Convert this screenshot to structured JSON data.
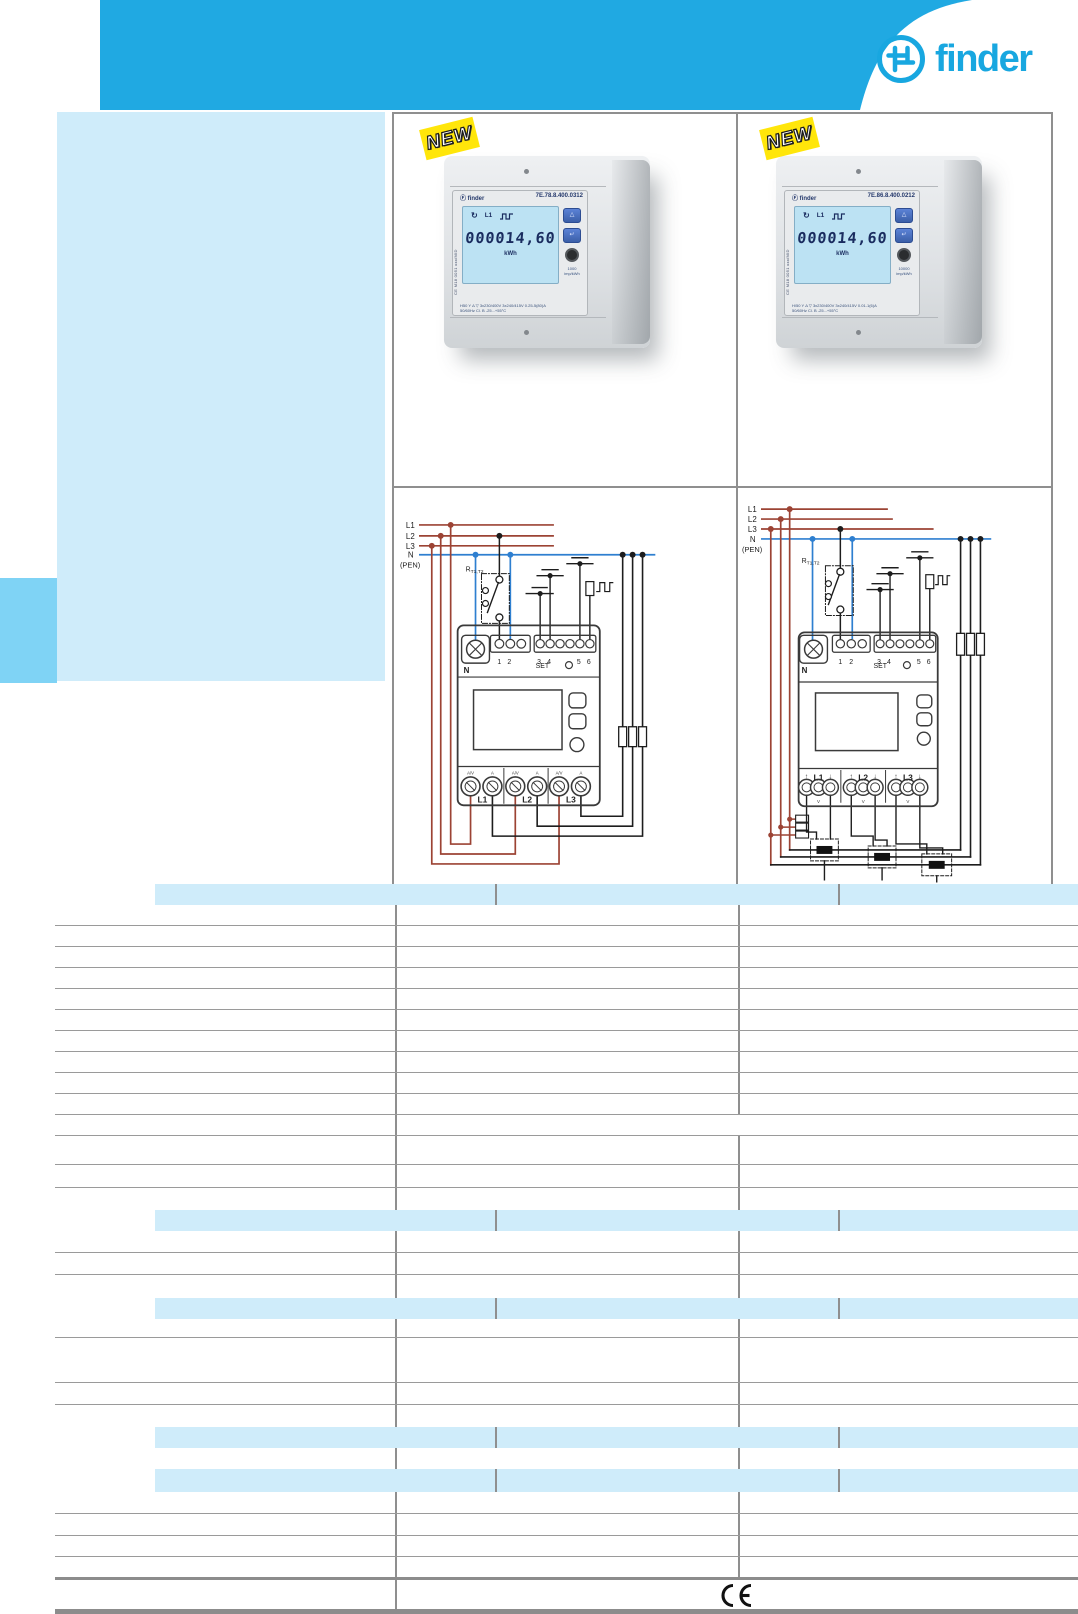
{
  "header": {
    "brand": "finder"
  },
  "products": [
    {
      "badge": "NEW",
      "brand_label": "Ⓕ finder",
      "model": "7E.78.8.400.0312",
      "cert": "CE M18 0051 xxx/MID",
      "lcd": {
        "phase": "L1",
        "value": "000014,60",
        "unit": "kWh"
      },
      "pulse_rate": "1000",
      "pulse_unit": "imp/kWh",
      "ratings_line1": "H50   Y Δ ▽   3x230/400V  3x240/415V   0.25-5(80)A",
      "ratings_line2": "50/60Hz   Cl. B    -25...+55°C"
    },
    {
      "badge": "NEW",
      "brand_label": "Ⓕ finder",
      "model": "7E.86.8.400.0212",
      "cert": "CE M18 0051 xxx/MID",
      "lcd": {
        "phase": "L1",
        "value": "000014,60",
        "unit": "kWh"
      },
      "pulse_rate": "10000",
      "pulse_unit": "imp/kWh",
      "ratings_line1": "H/50   Y Δ ▽   3x230/400V  3x240/415V   0.01-1(6)A",
      "ratings_line2": "50/60Hz   Cl. B    -25...+55°C"
    }
  ],
  "icons": {
    "rotate": "↻",
    "up": "△",
    "enter": "↵"
  },
  "diagram": {
    "lines": [
      "L1",
      "L2",
      "L3",
      "N",
      "(PEN)"
    ],
    "relay": "R",
    "relay_sub": "T1,T2",
    "terminals": [
      "1",
      "2",
      "3",
      "4",
      "5",
      "6"
    ],
    "set_label": "SET",
    "neutral": "N",
    "phases": [
      "L1",
      "L2",
      "L3"
    ],
    "marking_av": "A/V",
    "marking_a": "A",
    "volt": "V",
    "arrow_up": "↑",
    "arrow_down": "↓"
  },
  "colors": {
    "accent": "#20A9E2",
    "panel": "#CFECFA",
    "tab": "#7FD3F5",
    "wire_red": "#9C4334",
    "wire_blue": "#2E7FD0"
  },
  "table": {
    "rows": [
      {
        "h": 21,
        "kind": "band"
      },
      {
        "h": 21,
        "kind": "row",
        "lined": true
      },
      {
        "h": 21,
        "kind": "row",
        "lined": true
      },
      {
        "h": 21,
        "kind": "row",
        "lined": true
      },
      {
        "h": 21,
        "kind": "row",
        "lined": true
      },
      {
        "h": 21,
        "kind": "row",
        "lined": true
      },
      {
        "h": 21,
        "kind": "row",
        "lined": true
      },
      {
        "h": 21,
        "kind": "row",
        "lined": true
      },
      {
        "h": 21,
        "kind": "row",
        "lined": true
      },
      {
        "h": 21,
        "kind": "row",
        "lined": true
      },
      {
        "h": 21,
        "kind": "row",
        "lined": true
      },
      {
        "h": 21,
        "kind": "row",
        "lined": true,
        "d2": false
      },
      {
        "h": 29,
        "kind": "row",
        "lined": true
      },
      {
        "h": 23,
        "kind": "row",
        "lined": true
      },
      {
        "h": 22,
        "kind": "row",
        "lined": false
      },
      {
        "h": 21,
        "kind": "band"
      },
      {
        "h": 22,
        "kind": "row",
        "lined": true
      },
      {
        "h": 22,
        "kind": "row",
        "lined": true
      },
      {
        "h": 23,
        "kind": "row",
        "lined": false
      },
      {
        "h": 21,
        "kind": "band"
      },
      {
        "h": 19,
        "kind": "row",
        "lined": true
      },
      {
        "h": 45,
        "kind": "row",
        "lined": true
      },
      {
        "h": 22,
        "kind": "row",
        "lined": true
      },
      {
        "h": 22,
        "kind": "row",
        "lined": false
      },
      {
        "h": 21,
        "kind": "band"
      },
      {
        "h": 21,
        "kind": "row",
        "lined": false
      },
      {
        "h": 23,
        "kind": "band"
      },
      {
        "h": 22,
        "kind": "row",
        "lined": true
      },
      {
        "h": 22,
        "kind": "row",
        "lined": true
      },
      {
        "h": 21,
        "kind": "row",
        "lined": true
      },
      {
        "h": 20,
        "kind": "row",
        "lined": false
      },
      {
        "h": 32,
        "kind": "ce",
        "d2": false
      },
      {
        "h": 5,
        "kind": "bar"
      }
    ]
  },
  "footer": {
    "ce": "CE"
  }
}
